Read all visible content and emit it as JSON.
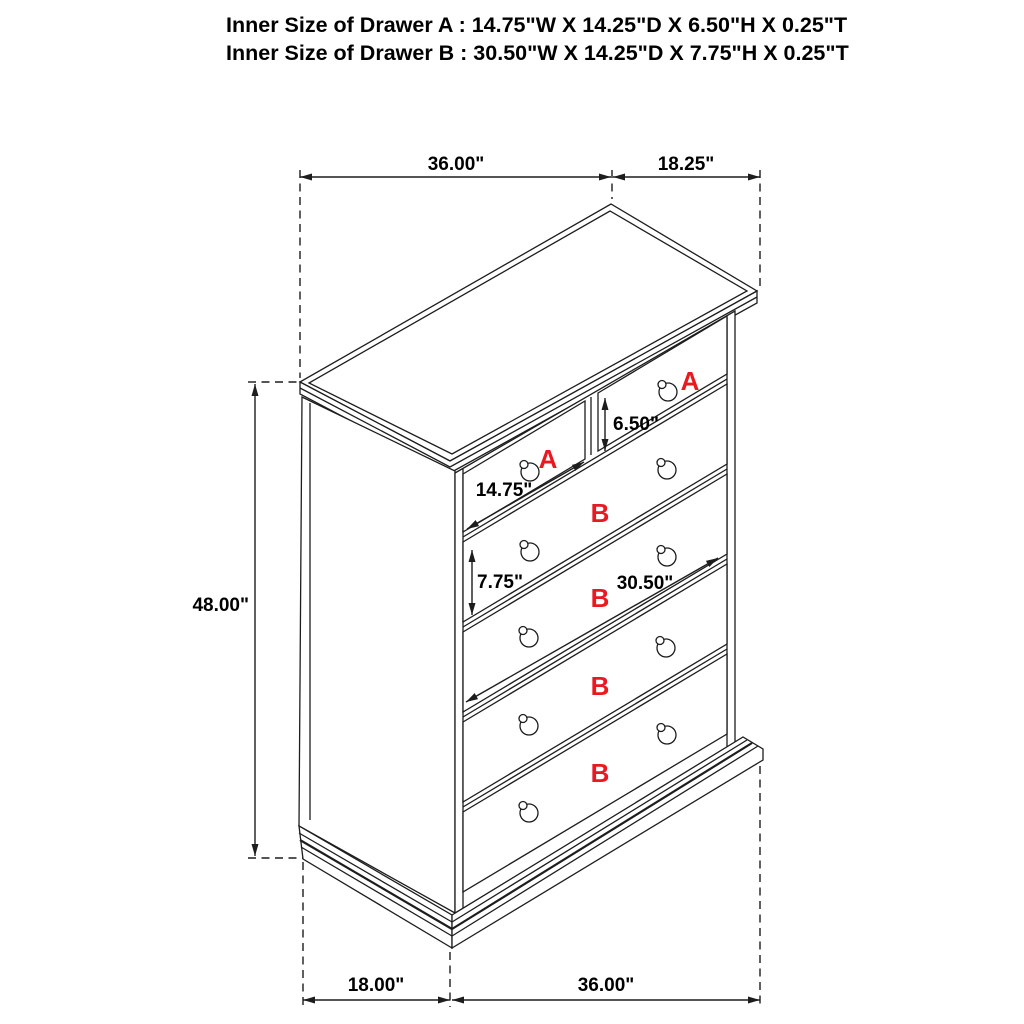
{
  "header": {
    "line1": "Inner Size of Drawer A : 14.75\"W X 14.25\"D X 6.50\"H X 0.25\"T",
    "line2": "Inner Size of Drawer B : 30.50\"W X 14.25\"D X 7.75\"H X 0.25\"T"
  },
  "dimensions": {
    "top_width": "36.00\"",
    "top_depth": "18.25\"",
    "overall_height": "48.00\"",
    "drawer_a_inner_height": "6.50\"",
    "drawer_a_inner_width": "14.75\"",
    "drawer_b_inner_height": "7.75\"",
    "drawer_b_inner_width": "30.50\"",
    "base_depth": "18.00\"",
    "base_width": "36.00\""
  },
  "drawer_labels": {
    "top_left": "A",
    "top_right": "A",
    "row2": "B",
    "row3": "B",
    "row4": "B",
    "row5": "B"
  },
  "colors": {
    "line": "#1d1d1d",
    "red_label": "#e8191f",
    "text": "#000000",
    "background": "#ffffff"
  }
}
